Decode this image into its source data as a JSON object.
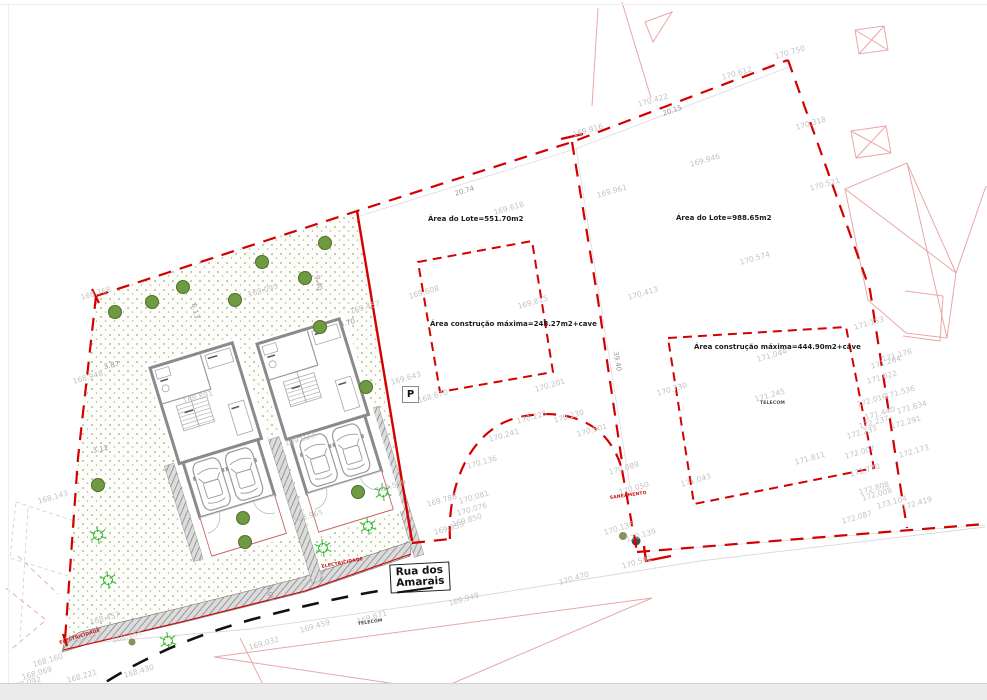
{
  "colors": {
    "boundary_red": "#d40000",
    "neighbor_pink": "#eaa6a6",
    "label_gray": "#c4c1c1",
    "wall_gray": "#8a8a8a",
    "tree_green": "#6f9a42",
    "bush_green": "#2eb82e",
    "road_black": "#111111"
  },
  "lot1": {
    "area_label": "Área do Lote=551.70m2",
    "construction_label": "Área construção máxima=248.27m2+cave"
  },
  "lot2": {
    "area_label": "Área do Lote=988.65m2",
    "construction_label": "Área construção máxima=444.90m2+cave"
  },
  "street": {
    "line1": "Rua dos",
    "line2": "Amarais"
  },
  "parking": {
    "label": "P"
  },
  "utilities": [
    {
      "t": "ELECTRICIDADE",
      "x": 322,
      "y": 566,
      "c": "red",
      "r": -11
    },
    {
      "t": "ELECTRICIDADE",
      "x": 60,
      "y": 642,
      "c": "red",
      "r": -18
    },
    {
      "t": "SANEAMENTO",
      "x": 610,
      "y": 497,
      "c": "red",
      "r": -8
    },
    {
      "t": "TELECOM",
      "x": 760,
      "y": 402,
      "c": "dark",
      "r": 0
    },
    {
      "t": "TELECOM",
      "x": 358,
      "y": 623,
      "c": "dark",
      "r": -8
    }
  ],
  "dimensions": [
    {
      "t": "20.74",
      "x": 455,
      "y": 191,
      "r": -17
    },
    {
      "t": "20.15",
      "x": 663,
      "y": 111,
      "r": -19
    },
    {
      "t": "9.40",
      "x": 316,
      "y": 272,
      "r": 77
    },
    {
      "t": "6.13",
      "x": 193,
      "y": 300,
      "r": 77
    },
    {
      "t": "3.70",
      "x": 340,
      "y": 322,
      "r": -15
    },
    {
      "t": "3.87",
      "x": 104,
      "y": 364,
      "r": -12
    },
    {
      "t": "3.12",
      "x": 93,
      "y": 448,
      "r": -12
    },
    {
      "t": "4.00",
      "x": 268,
      "y": 582,
      "r": 80
    },
    {
      "t": "39.40",
      "x": 615,
      "y": 348,
      "r": 80
    }
  ],
  "elevations": [
    {
      "t": "169.916",
      "x": 573,
      "y": 131
    },
    {
      "t": "169.946",
      "x": 690,
      "y": 161
    },
    {
      "t": "169.961",
      "x": 597,
      "y": 192
    },
    {
      "t": "170.422",
      "x": 638,
      "y": 101
    },
    {
      "t": "170.612",
      "x": 722,
      "y": 74
    },
    {
      "t": "170.750",
      "x": 775,
      "y": 53
    },
    {
      "t": "170.318",
      "x": 796,
      "y": 124
    },
    {
      "t": "170.521",
      "x": 810,
      "y": 185
    },
    {
      "t": "170.574",
      "x": 740,
      "y": 259
    },
    {
      "t": "170.413",
      "x": 628,
      "y": 294
    },
    {
      "t": "169.618",
      "x": 494,
      "y": 209
    },
    {
      "t": "169.608",
      "x": 409,
      "y": 293
    },
    {
      "t": "169.815",
      "x": 518,
      "y": 303
    },
    {
      "t": "169.457",
      "x": 350,
      "y": 308
    },
    {
      "t": "169.095",
      "x": 248,
      "y": 291
    },
    {
      "t": "168.768",
      "x": 81,
      "y": 294
    },
    {
      "t": "168.948",
      "x": 73,
      "y": 378
    },
    {
      "t": "168.143",
      "x": 38,
      "y": 498
    },
    {
      "t": "168.891",
      "x": 183,
      "y": 398
    },
    {
      "t": "169.023",
      "x": 285,
      "y": 440
    },
    {
      "t": "168.965",
      "x": 293,
      "y": 517
    },
    {
      "t": "169.589",
      "x": 376,
      "y": 487
    },
    {
      "t": "169.643",
      "x": 391,
      "y": 379
    },
    {
      "t": "168.670",
      "x": 418,
      "y": 397
    },
    {
      "t": "170.201",
      "x": 535,
      "y": 386
    },
    {
      "t": "170.225",
      "x": 517,
      "y": 418
    },
    {
      "t": "170.230",
      "x": 554,
      "y": 417
    },
    {
      "t": "170.501",
      "x": 577,
      "y": 431
    },
    {
      "t": "170.241",
      "x": 489,
      "y": 436
    },
    {
      "t": "170.136",
      "x": 467,
      "y": 463
    },
    {
      "t": "170.081",
      "x": 459,
      "y": 498
    },
    {
      "t": "170.076",
      "x": 457,
      "y": 510
    },
    {
      "t": "169.850",
      "x": 452,
      "y": 521
    },
    {
      "t": "169.788",
      "x": 427,
      "y": 501
    },
    {
      "t": "169.853",
      "x": 434,
      "y": 529
    },
    {
      "t": "170.089",
      "x": 609,
      "y": 469
    },
    {
      "t": "170.050",
      "x": 619,
      "y": 489
    },
    {
      "t": "170.136",
      "x": 604,
      "y": 529
    },
    {
      "t": "170.139",
      "x": 626,
      "y": 536
    },
    {
      "t": "170.730",
      "x": 657,
      "y": 390
    },
    {
      "t": "171.044",
      "x": 757,
      "y": 356
    },
    {
      "t": "171.245",
      "x": 755,
      "y": 396
    },
    {
      "t": "171.043",
      "x": 681,
      "y": 481
    },
    {
      "t": "171.811",
      "x": 795,
      "y": 459
    },
    {
      "t": "171.153",
      "x": 854,
      "y": 324
    },
    {
      "t": "171.176",
      "x": 882,
      "y": 356
    },
    {
      "t": "171.264",
      "x": 871,
      "y": 363
    },
    {
      "t": "171.022",
      "x": 867,
      "y": 378
    },
    {
      "t": "171.536",
      "x": 885,
      "y": 393
    },
    {
      "t": "172.016",
      "x": 857,
      "y": 401
    },
    {
      "t": "171.634",
      "x": 897,
      "y": 408
    },
    {
      "t": "171.440",
      "x": 865,
      "y": 414
    },
    {
      "t": "172.237",
      "x": 859,
      "y": 423
    },
    {
      "t": "172.291",
      "x": 891,
      "y": 423
    },
    {
      "t": "172.233",
      "x": 847,
      "y": 433
    },
    {
      "t": "172.007",
      "x": 845,
      "y": 453
    },
    {
      "t": "172.173",
      "x": 899,
      "y": 452
    },
    {
      "t": "172.770",
      "x": 850,
      "y": 471
    },
    {
      "t": "172.808",
      "x": 859,
      "y": 489
    },
    {
      "t": "172.008",
      "x": 862,
      "y": 495
    },
    {
      "t": "173.104",
      "x": 877,
      "y": 503
    },
    {
      "t": "172.419",
      "x": 902,
      "y": 504
    },
    {
      "t": "172.087",
      "x": 842,
      "y": 518
    },
    {
      "t": "170.592",
      "x": 622,
      "y": 563
    },
    {
      "t": "170.470",
      "x": 559,
      "y": 579
    },
    {
      "t": "169.949",
      "x": 449,
      "y": 600
    },
    {
      "t": "169.671",
      "x": 357,
      "y": 618
    },
    {
      "t": "169.459",
      "x": 300,
      "y": 627
    },
    {
      "t": "169.032",
      "x": 249,
      "y": 644
    },
    {
      "t": "168.430",
      "x": 124,
      "y": 672
    },
    {
      "t": "168.165",
      "x": 112,
      "y": 637
    },
    {
      "t": "168.457",
      "x": 90,
      "y": 619
    },
    {
      "t": "168.472",
      "x": 72,
      "y": 638
    },
    {
      "t": "168.160",
      "x": 33,
      "y": 661
    },
    {
      "t": "168.069",
      "x": 22,
      "y": 674
    },
    {
      "t": "168.092",
      "x": 11,
      "y": 684
    },
    {
      "t": "168.221",
      "x": 67,
      "y": 677
    }
  ],
  "site": {
    "trees": [
      {
        "x": 115,
        "y": 312
      },
      {
        "x": 152,
        "y": 302
      },
      {
        "x": 183,
        "y": 287
      },
      {
        "x": 235,
        "y": 300
      },
      {
        "x": 262,
        "y": 262
      },
      {
        "x": 305,
        "y": 278
      },
      {
        "x": 325,
        "y": 243
      },
      {
        "x": 320,
        "y": 327
      },
      {
        "x": 366,
        "y": 387
      },
      {
        "x": 358,
        "y": 492
      },
      {
        "x": 243,
        "y": 518
      },
      {
        "x": 245,
        "y": 542
      },
      {
        "x": 98,
        "y": 485
      }
    ],
    "dots": [
      {
        "x": 623,
        "y": 536,
        "c": "#8a8f5e",
        "r": 4
      },
      {
        "x": 636,
        "y": 541,
        "c": "#4a4a4a",
        "r": 4.5
      },
      {
        "x": 132,
        "y": 642,
        "c": "#8a8f5e",
        "r": 3.5
      }
    ],
    "bushes": [
      {
        "x": 98,
        "y": 535
      },
      {
        "x": 108,
        "y": 580
      },
      {
        "x": 368,
        "y": 526
      },
      {
        "x": 383,
        "y": 492
      },
      {
        "x": 168,
        "y": 641
      },
      {
        "x": 323,
        "y": 548
      }
    ]
  }
}
